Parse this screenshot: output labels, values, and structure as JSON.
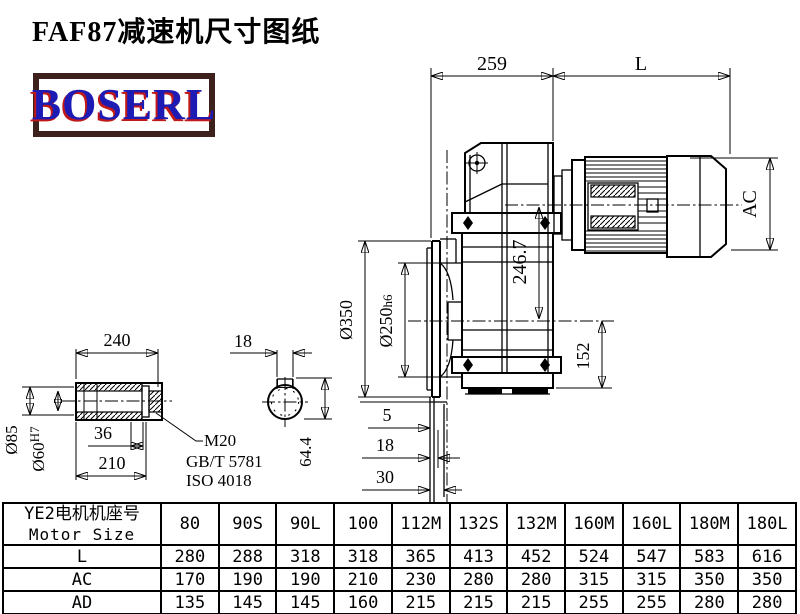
{
  "title": "FAF87减速机尺寸图纸",
  "logo": {
    "text": "BOSERL"
  },
  "drawing": {
    "dims": {
      "top_left": "259",
      "top_right": "L",
      "motor_height": "AC",
      "axis_height": "246.7",
      "bottom_height": "152",
      "flange_od": "Ø350",
      "spigot_prefix": "Ø250",
      "spigot_tol": "h6",
      "stub5": "5",
      "stub18": "18",
      "stub30": "30",
      "shaft_len": "240",
      "shaft_od": "Ø85",
      "bore_prefix": "Ø60",
      "bore_tol": "H7",
      "recess": "36",
      "hub_len": "210",
      "key_w": "18",
      "key_h": "64.4",
      "note1": "M20",
      "note2": "GB/T 5781",
      "note3": "ISO 4018"
    }
  },
  "table": {
    "header_cn": "YE2电机机座号",
    "header_en": "Motor Size",
    "columns": [
      "80",
      "90S",
      "90L",
      "100",
      "112M",
      "132S",
      "132M",
      "160M",
      "160L",
      "180M",
      "180L"
    ],
    "rows": [
      {
        "label": "L",
        "values": [
          "280",
          "288",
          "318",
          "318",
          "365",
          "413",
          "452",
          "524",
          "547",
          "583",
          "616"
        ]
      },
      {
        "label": "AC",
        "values": [
          "170",
          "190",
          "190",
          "210",
          "230",
          "280",
          "280",
          "315",
          "315",
          "350",
          "350"
        ]
      },
      {
        "label": "AD",
        "values": [
          "135",
          "145",
          "145",
          "160",
          "215",
          "215",
          "215",
          "255",
          "255",
          "280",
          "280"
        ]
      }
    ]
  }
}
